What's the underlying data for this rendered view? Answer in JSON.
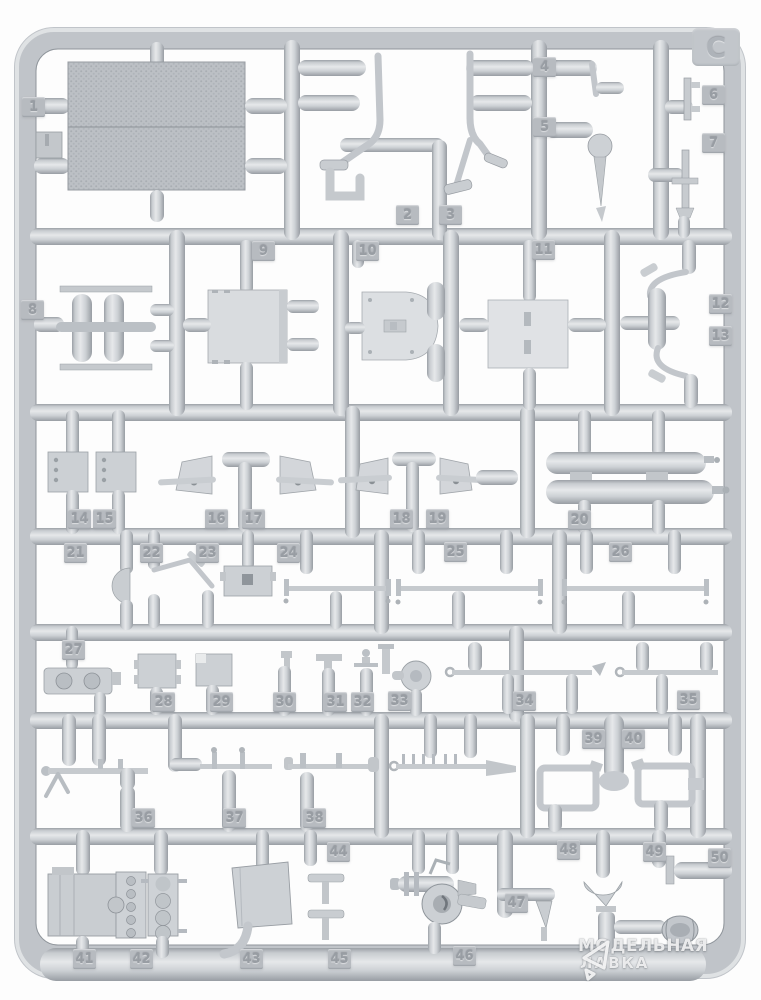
{
  "sprue": {
    "letter": "C"
  },
  "part_tags": [
    {
      "n": "1",
      "x": 22,
      "y": 97
    },
    {
      "n": "2",
      "x": 396,
      "y": 205
    },
    {
      "n": "3",
      "x": 439,
      "y": 205
    },
    {
      "n": "4",
      "x": 533,
      "y": 57
    },
    {
      "n": "5",
      "x": 533,
      "y": 117
    },
    {
      "n": "6",
      "x": 702,
      "y": 85
    },
    {
      "n": "7",
      "x": 702,
      "y": 133
    },
    {
      "n": "8",
      "x": 21,
      "y": 300
    },
    {
      "n": "9",
      "x": 252,
      "y": 241
    },
    {
      "n": "10",
      "x": 356,
      "y": 241
    },
    {
      "n": "11",
      "x": 532,
      "y": 240
    },
    {
      "n": "12",
      "x": 709,
      "y": 294
    },
    {
      "n": "13",
      "x": 709,
      "y": 326
    },
    {
      "n": "14",
      "x": 68,
      "y": 509
    },
    {
      "n": "15",
      "x": 93,
      "y": 509
    },
    {
      "n": "16",
      "x": 205,
      "y": 509
    },
    {
      "n": "17",
      "x": 242,
      "y": 509
    },
    {
      "n": "18",
      "x": 390,
      "y": 509
    },
    {
      "n": "19",
      "x": 426,
      "y": 509
    },
    {
      "n": "20",
      "x": 568,
      "y": 510
    },
    {
      "n": "21",
      "x": 64,
      "y": 543
    },
    {
      "n": "22",
      "x": 140,
      "y": 543
    },
    {
      "n": "23",
      "x": 196,
      "y": 543
    },
    {
      "n": "24",
      "x": 277,
      "y": 543
    },
    {
      "n": "25",
      "x": 444,
      "y": 542
    },
    {
      "n": "26",
      "x": 609,
      "y": 542
    },
    {
      "n": "27",
      "x": 62,
      "y": 640
    },
    {
      "n": "28",
      "x": 152,
      "y": 692
    },
    {
      "n": "29",
      "x": 210,
      "y": 692
    },
    {
      "n": "30",
      "x": 273,
      "y": 692
    },
    {
      "n": "31",
      "x": 324,
      "y": 692
    },
    {
      "n": "32",
      "x": 351,
      "y": 692
    },
    {
      "n": "33",
      "x": 388,
      "y": 691
    },
    {
      "n": "34",
      "x": 513,
      "y": 691
    },
    {
      "n": "35",
      "x": 677,
      "y": 690
    },
    {
      "n": "36",
      "x": 132,
      "y": 808
    },
    {
      "n": "37",
      "x": 223,
      "y": 808
    },
    {
      "n": "38",
      "x": 303,
      "y": 808
    },
    {
      "n": "39",
      "x": 582,
      "y": 729
    },
    {
      "n": "40",
      "x": 622,
      "y": 729
    },
    {
      "n": "41",
      "x": 73,
      "y": 949
    },
    {
      "n": "42",
      "x": 130,
      "y": 949
    },
    {
      "n": "43",
      "x": 240,
      "y": 949
    },
    {
      "n": "44",
      "x": 327,
      "y": 842
    },
    {
      "n": "45",
      "x": 328,
      "y": 949
    },
    {
      "n": "46",
      "x": 453,
      "y": 946
    },
    {
      "n": "47",
      "x": 505,
      "y": 893
    },
    {
      "n": "48",
      "x": 557,
      "y": 840
    },
    {
      "n": "49",
      "x": 643,
      "y": 842
    },
    {
      "n": "50",
      "x": 708,
      "y": 848
    }
  ],
  "watermark": {
    "line1": "МОДЕЛЬНАЯ",
    "line2": "ЛАВКА",
    "logo": "modelnaya-lavka-triangle-logo"
  },
  "colors": {
    "background": "#fdfdfd",
    "plastic_base": "#c6cacf",
    "plastic_light": "#e6e8ea",
    "plastic_shadow": "#9aa0a6",
    "tag_background": "#b7bbc0",
    "tag_text": "#989da3",
    "watermark_text": "rgba(255,255,255,0.85)"
  }
}
